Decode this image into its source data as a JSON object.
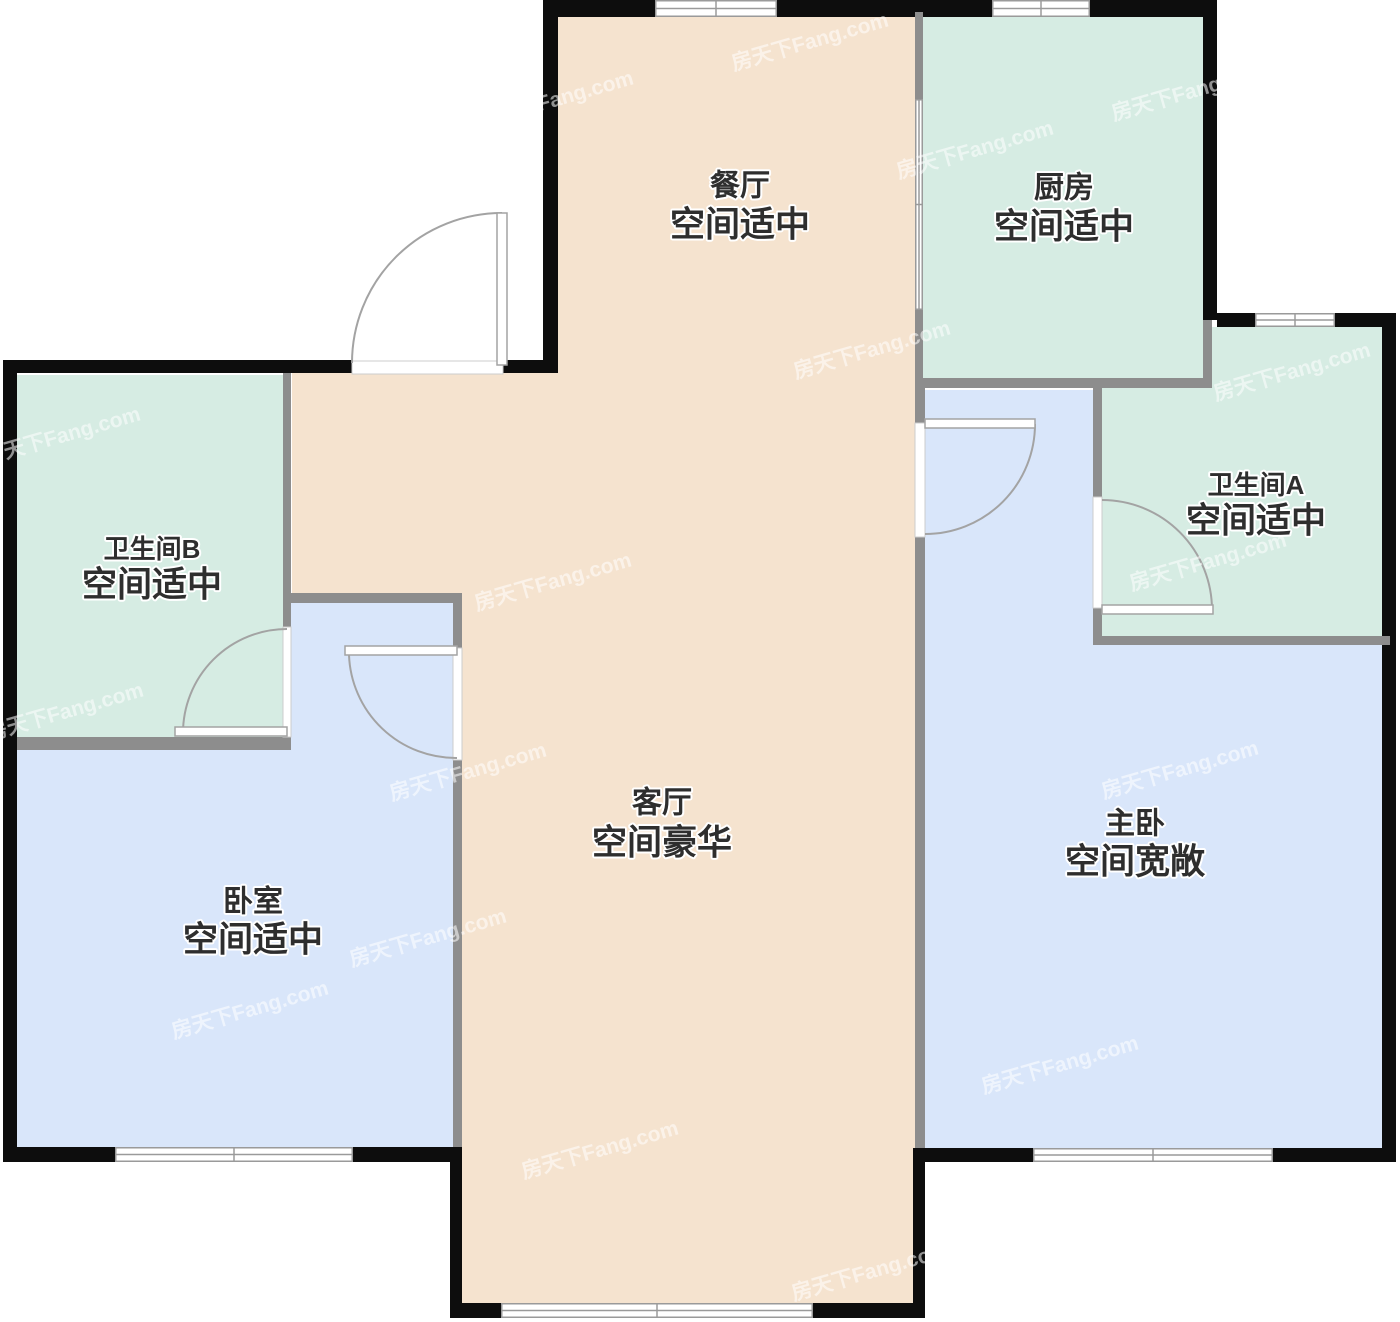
{
  "canvas": {
    "width": 1400,
    "height": 1322
  },
  "colors": {
    "dining": "#f5e3cf",
    "kitchen_bath": "#d6ece3",
    "bedroom": "#d9e6fa",
    "wall": "#0d0d0d",
    "partition": "#8d8d8d",
    "frame": "#9a9a9a",
    "door": "#a3a3a3",
    "door_fill": "#ffffff",
    "label": "#2e2e2e",
    "background": "#ffffff"
  },
  "watermark": {
    "text": "房天下Fang.com",
    "color": "rgba(255,255,255,0.55)",
    "font_size": 21,
    "rotation": -16,
    "positions": [
      [
        810,
        42
      ],
      [
        555,
        100
      ],
      [
        1190,
        92
      ],
      [
        975,
        150
      ],
      [
        205,
        292
      ],
      [
        872,
        350
      ],
      [
        1292,
        372
      ],
      [
        62,
        436
      ],
      [
        553,
        582
      ],
      [
        1208,
        562
      ],
      [
        65,
        712
      ],
      [
        468,
        772
      ],
      [
        1180,
        770
      ],
      [
        428,
        938
      ],
      [
        250,
        1010
      ],
      [
        1060,
        1065
      ],
      [
        600,
        1150
      ],
      [
        870,
        1272
      ]
    ]
  },
  "rooms": [
    {
      "id": "dining",
      "name": "餐厅",
      "spec": "空间适中",
      "cx": 740,
      "name_y": 186,
      "spec_y": 225,
      "name_size": 30,
      "spec_size": 35
    },
    {
      "id": "kitchen",
      "name": "厨房",
      "spec": "空间适中",
      "cx": 1064,
      "name_y": 188,
      "spec_y": 227,
      "name_size": 30,
      "spec_size": 35
    },
    {
      "id": "bathroom-a",
      "name": "卫生间A",
      "spec": "空间适中",
      "cx": 1256,
      "name_y": 485,
      "spec_y": 521,
      "name_size": 26,
      "spec_size": 35
    },
    {
      "id": "bathroom-b",
      "name": "卫生间B",
      "spec": "空间适中",
      "cx": 152,
      "name_y": 549,
      "spec_y": 585,
      "name_size": 26,
      "spec_size": 35
    },
    {
      "id": "living",
      "name": "客厅",
      "spec": "空间豪华",
      "cx": 662,
      "name_y": 803,
      "spec_y": 843,
      "name_size": 30,
      "spec_size": 35
    },
    {
      "id": "master",
      "name": "主卧",
      "spec": "空间宽敞",
      "cx": 1135,
      "name_y": 824,
      "spec_y": 862,
      "name_size": 30,
      "spec_size": 35
    },
    {
      "id": "bedroom",
      "name": "卧室",
      "spec": "空间适中",
      "cx": 253,
      "name_y": 902,
      "spec_y": 940,
      "name_size": 30,
      "spec_size": 35
    }
  ],
  "floor_regions": [
    {
      "id": "dining-floor",
      "color": "dining",
      "rect": [
        558,
        17,
        357,
        356
      ]
    },
    {
      "id": "foyer-floor",
      "color": "dining",
      "rect": [
        292,
        373,
        623,
        220
      ]
    },
    {
      "id": "living-floor",
      "color": "dining",
      "rect": [
        462,
        593,
        453,
        710
      ]
    },
    {
      "id": "bedroom-floor",
      "color": "bedroom",
      "rect": [
        17,
        601,
        436,
        546
      ]
    },
    {
      "id": "master-bedroom-floor",
      "color": "bedroom",
      "rect": [
        925,
        390,
        458,
        758
      ]
    },
    {
      "id": "kitchen-floor",
      "color": "kitchen_bath",
      "rect": [
        922,
        17,
        281,
        361
      ]
    },
    {
      "id": "bathroom-b-floor",
      "color": "kitchen_bath",
      "rect": [
        17,
        375,
        266,
        362
      ]
    },
    {
      "id": "bathroom-a-floor-right",
      "color": "kitchen_bath",
      "rect": [
        1212,
        327,
        171,
        310
      ]
    },
    {
      "id": "bathroom-a-floor-left",
      "color": "kitchen_bath",
      "rect": [
        1102,
        388,
        110,
        249
      ]
    }
  ],
  "exterior_walls": [
    {
      "id": "dining-top-wall-left",
      "rect": [
        543,
        0,
        112,
        17
      ]
    },
    {
      "id": "dining-top-wall-right",
      "rect": [
        777,
        0,
        145,
        17
      ]
    },
    {
      "id": "kitchen-top-wall-left",
      "rect": [
        922,
        0,
        70,
        17
      ]
    },
    {
      "id": "kitchen-top-wall-right",
      "rect": [
        1090,
        0,
        127,
        17
      ]
    },
    {
      "id": "kitchen-right-wall",
      "rect": [
        1203,
        0,
        14,
        320
      ]
    },
    {
      "id": "bathroom-a-top-wall-left",
      "rect": [
        1217,
        313,
        38,
        14
      ]
    },
    {
      "id": "bathroom-a-top-wall-right",
      "rect": [
        1335,
        313,
        61,
        14
      ]
    },
    {
      "id": "right-wall",
      "rect": [
        1382,
        313,
        14,
        849
      ]
    },
    {
      "id": "master-bottom-wall-left",
      "rect": [
        922,
        1148,
        111,
        14
      ]
    },
    {
      "id": "master-bottom-wall-right",
      "rect": [
        1273,
        1148,
        123,
        14
      ]
    },
    {
      "id": "balcony-right-wall",
      "rect": [
        913,
        1148,
        12,
        170
      ]
    },
    {
      "id": "balcony-bottom-wall-left",
      "rect": [
        450,
        1303,
        51,
        15
      ]
    },
    {
      "id": "balcony-bottom-wall-right",
      "rect": [
        813,
        1303,
        112,
        15
      ]
    },
    {
      "id": "balcony-left-wall",
      "rect": [
        450,
        1147,
        12,
        171
      ]
    },
    {
      "id": "bedroom-bottom-wall-left",
      "rect": [
        3,
        1147,
        112,
        15
      ]
    },
    {
      "id": "bedroom-bottom-wall-right",
      "rect": [
        353,
        1147,
        109,
        15
      ]
    },
    {
      "id": "left-wall",
      "rect": [
        3,
        362,
        14,
        800
      ]
    },
    {
      "id": "entry-top-wall-left",
      "rect": [
        3,
        360,
        349,
        13
      ]
    },
    {
      "id": "entry-top-wall-right",
      "rect": [
        503,
        360,
        55,
        13
      ]
    },
    {
      "id": "dining-left-wall",
      "rect": [
        543,
        0,
        15,
        373
      ]
    }
  ],
  "interior_walls": [
    {
      "id": "dining-kitchen-wall-upper",
      "rect": [
        915,
        12,
        8,
        87
      ]
    },
    {
      "id": "dining-kitchen-wall-lower",
      "rect": [
        915,
        310,
        8,
        75
      ]
    },
    {
      "id": "kitchen-bottom-wall",
      "rect": [
        915,
        378,
        297,
        10
      ]
    },
    {
      "id": "bathroom-a-kitchen-side-wall",
      "rect": [
        1203,
        320,
        9,
        68
      ]
    },
    {
      "id": "bathroom-a-left-wall-upper",
      "rect": [
        1093,
        388,
        9,
        109
      ]
    },
    {
      "id": "bathroom-a-left-wall-lower",
      "rect": [
        1093,
        608,
        9,
        37
      ]
    },
    {
      "id": "bathroom-a-bottom-wall",
      "rect": [
        1093,
        636,
        297,
        9
      ]
    },
    {
      "id": "master-left-wall-upper",
      "rect": [
        915,
        385,
        10,
        38
      ]
    },
    {
      "id": "master-left-wall-lower",
      "rect": [
        915,
        537,
        10,
        611
      ]
    },
    {
      "id": "bathroom-b-right-wall-upper",
      "rect": [
        283,
        373,
        8,
        254
      ]
    },
    {
      "id": "bathroom-b-right-wall-lower",
      "rect": [
        283,
        737,
        8,
        13
      ]
    },
    {
      "id": "bathroom-b-bottom-wall",
      "rect": [
        17,
        737,
        274,
        13
      ]
    },
    {
      "id": "bedroom-top-wall",
      "rect": [
        291,
        593,
        171,
        10
      ]
    },
    {
      "id": "bedroom-right-wall-upper",
      "rect": [
        453,
        593,
        9,
        55
      ]
    },
    {
      "id": "bedroom-right-wall-lower",
      "rect": [
        453,
        760,
        9,
        387
      ]
    }
  ],
  "windows": [
    {
      "id": "dining-window",
      "rect": [
        655,
        0,
        122,
        17
      ],
      "axis": "h"
    },
    {
      "id": "kitchen-window",
      "rect": [
        992,
        0,
        98,
        17
      ],
      "axis": "h"
    },
    {
      "id": "bathroom-a-window",
      "rect": [
        1255,
        313,
        80,
        14
      ],
      "axis": "h"
    },
    {
      "id": "bedroom-window",
      "rect": [
        115,
        1147,
        238,
        15
      ],
      "axis": "h"
    },
    {
      "id": "master-window",
      "rect": [
        1033,
        1148,
        240,
        14
      ],
      "axis": "h"
    },
    {
      "id": "living-window",
      "rect": [
        501,
        1303,
        312,
        15
      ],
      "axis": "h"
    },
    {
      "id": "kitchen-pass-window",
      "rect": [
        915,
        99,
        8,
        211
      ],
      "axis": "v"
    }
  ],
  "doors": [
    {
      "id": "entry-door",
      "opening": [
        352,
        361,
        151,
        13
      ],
      "leaf": [
        497,
        213,
        10,
        152
      ],
      "arc": "M352,363 A150,150 0 0 1 502,213"
    },
    {
      "id": "master-bedroom-door",
      "opening": [
        915,
        423,
        10,
        114
      ],
      "leaf": [
        925,
        419,
        110,
        9
      ],
      "arc": "M1035,424 A110,110 0 0 1 925,534"
    },
    {
      "id": "bathroom-a-door",
      "opening": [
        1093,
        497,
        9,
        111
      ],
      "leaf": [
        1102,
        605,
        111,
        9
      ],
      "arc": "M1102,500 A110,110 0 0 1 1212,610"
    },
    {
      "id": "bathroom-b-door",
      "opening": [
        283,
        627,
        8,
        110
      ],
      "leaf": [
        175,
        727,
        112,
        9
      ],
      "arc": "M287,629 A104,104 0 0 0 183,733"
    },
    {
      "id": "bedroom-door",
      "opening": [
        453,
        648,
        9,
        112
      ],
      "leaf": [
        345,
        646,
        112,
        9
      ],
      "arc": "M349,655 A107,107 0 0 0 457,758"
    }
  ]
}
